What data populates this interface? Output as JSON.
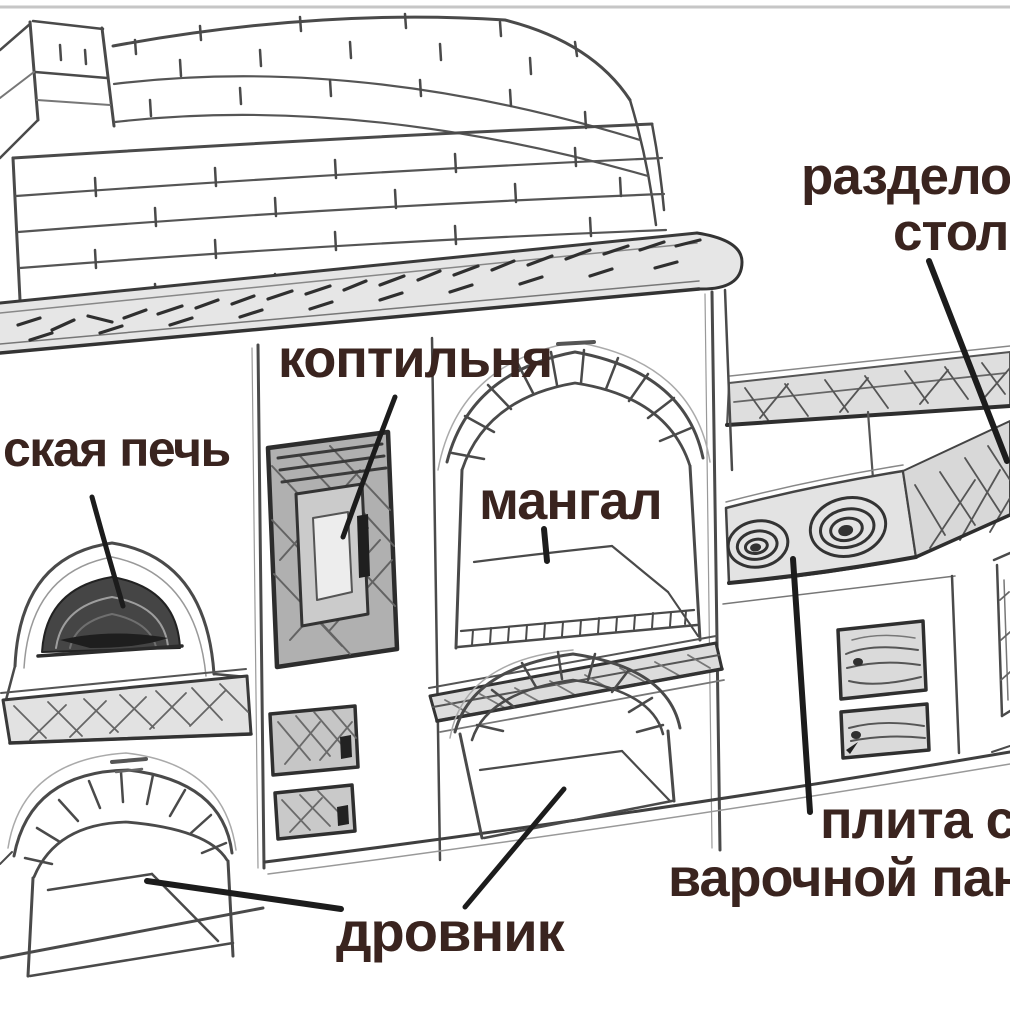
{
  "labels": {
    "smokehouse": "коптильня",
    "russian_oven": "ская печь",
    "grill": "мангал",
    "cutting_table": {
      "line1": "разделоч",
      "line2": "столи"
    },
    "stove": {
      "line1": "плита с",
      "line2": "варочной пан"
    },
    "woodshed": "дровник"
  },
  "colors": {
    "label_text": "#3a241f",
    "sketch_line": "#4a4a4a",
    "pointer_line": "#1c1c1c",
    "dark_shading": "#454545",
    "light_shading": "#e2e2e2",
    "background": "#ffffff"
  }
}
